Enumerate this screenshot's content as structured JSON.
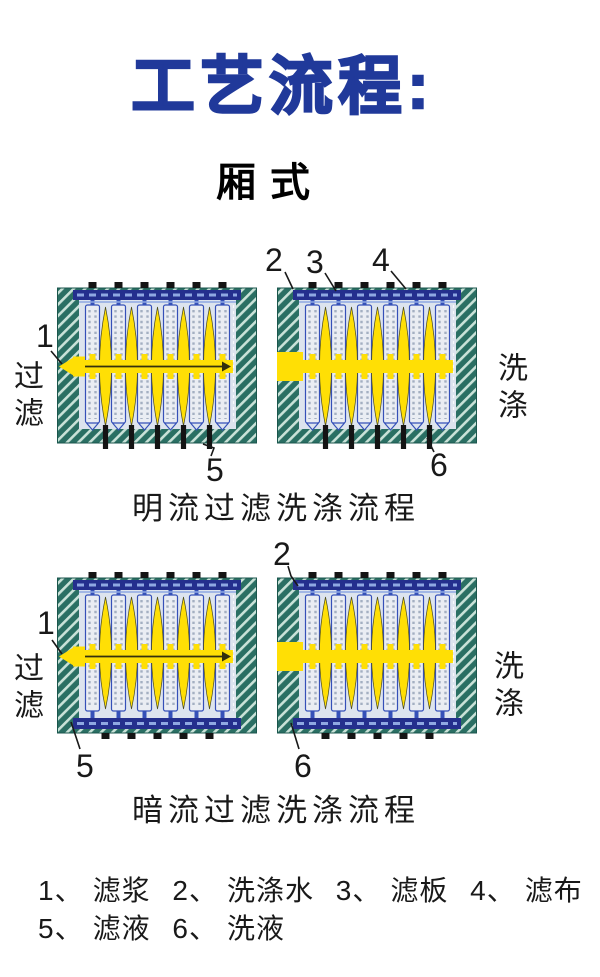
{
  "header": {
    "title": "工艺流程:",
    "subtitle": "厢式"
  },
  "sections": [
    {
      "caption": "明流过滤洗涤流程",
      "side_left": "过滤",
      "side_right": "洗涤",
      "callouts": {
        "c1": "1",
        "c2": "2",
        "c3": "3",
        "c4": "4",
        "c5": "5",
        "c6": "6"
      }
    },
    {
      "caption": "暗流过滤洗涤流程",
      "side_left": "过滤",
      "side_right": "洗涤",
      "callouts": {
        "c1": "1",
        "c2": "2",
        "c5": "5",
        "c6": "6"
      }
    }
  ],
  "legend": {
    "items": [
      {
        "num": "1、",
        "label": "滤浆"
      },
      {
        "num": "2、",
        "label": "洗涤水"
      },
      {
        "num": "3、",
        "label": "滤板"
      },
      {
        "num": "4、",
        "label": "滤布"
      },
      {
        "num": "5、",
        "label": "滤液"
      },
      {
        "num": "6、",
        "label": "洗液"
      }
    ]
  },
  "colors": {
    "title_blue": "#20399a",
    "text_black": "#191919",
    "hatch_dark": "#2a6f63",
    "hatch_light": "#c9e2d8",
    "box_edge": "#1b564c",
    "inner_fill": "#dde4ee",
    "plate_fill": "#eaedf3",
    "plate_edge": "#3550b8",
    "cloth_dot": "#a4afc2",
    "navy_bar": "#242f8d",
    "bar_dash": "#8fa8e2",
    "chamber_yellow": "#ffdf05",
    "lens_edge": "#4a4a20",
    "black_part": "#141414",
    "arrow_dark": "#33300e",
    "end_plate_dash": "#ffffff"
  }
}
